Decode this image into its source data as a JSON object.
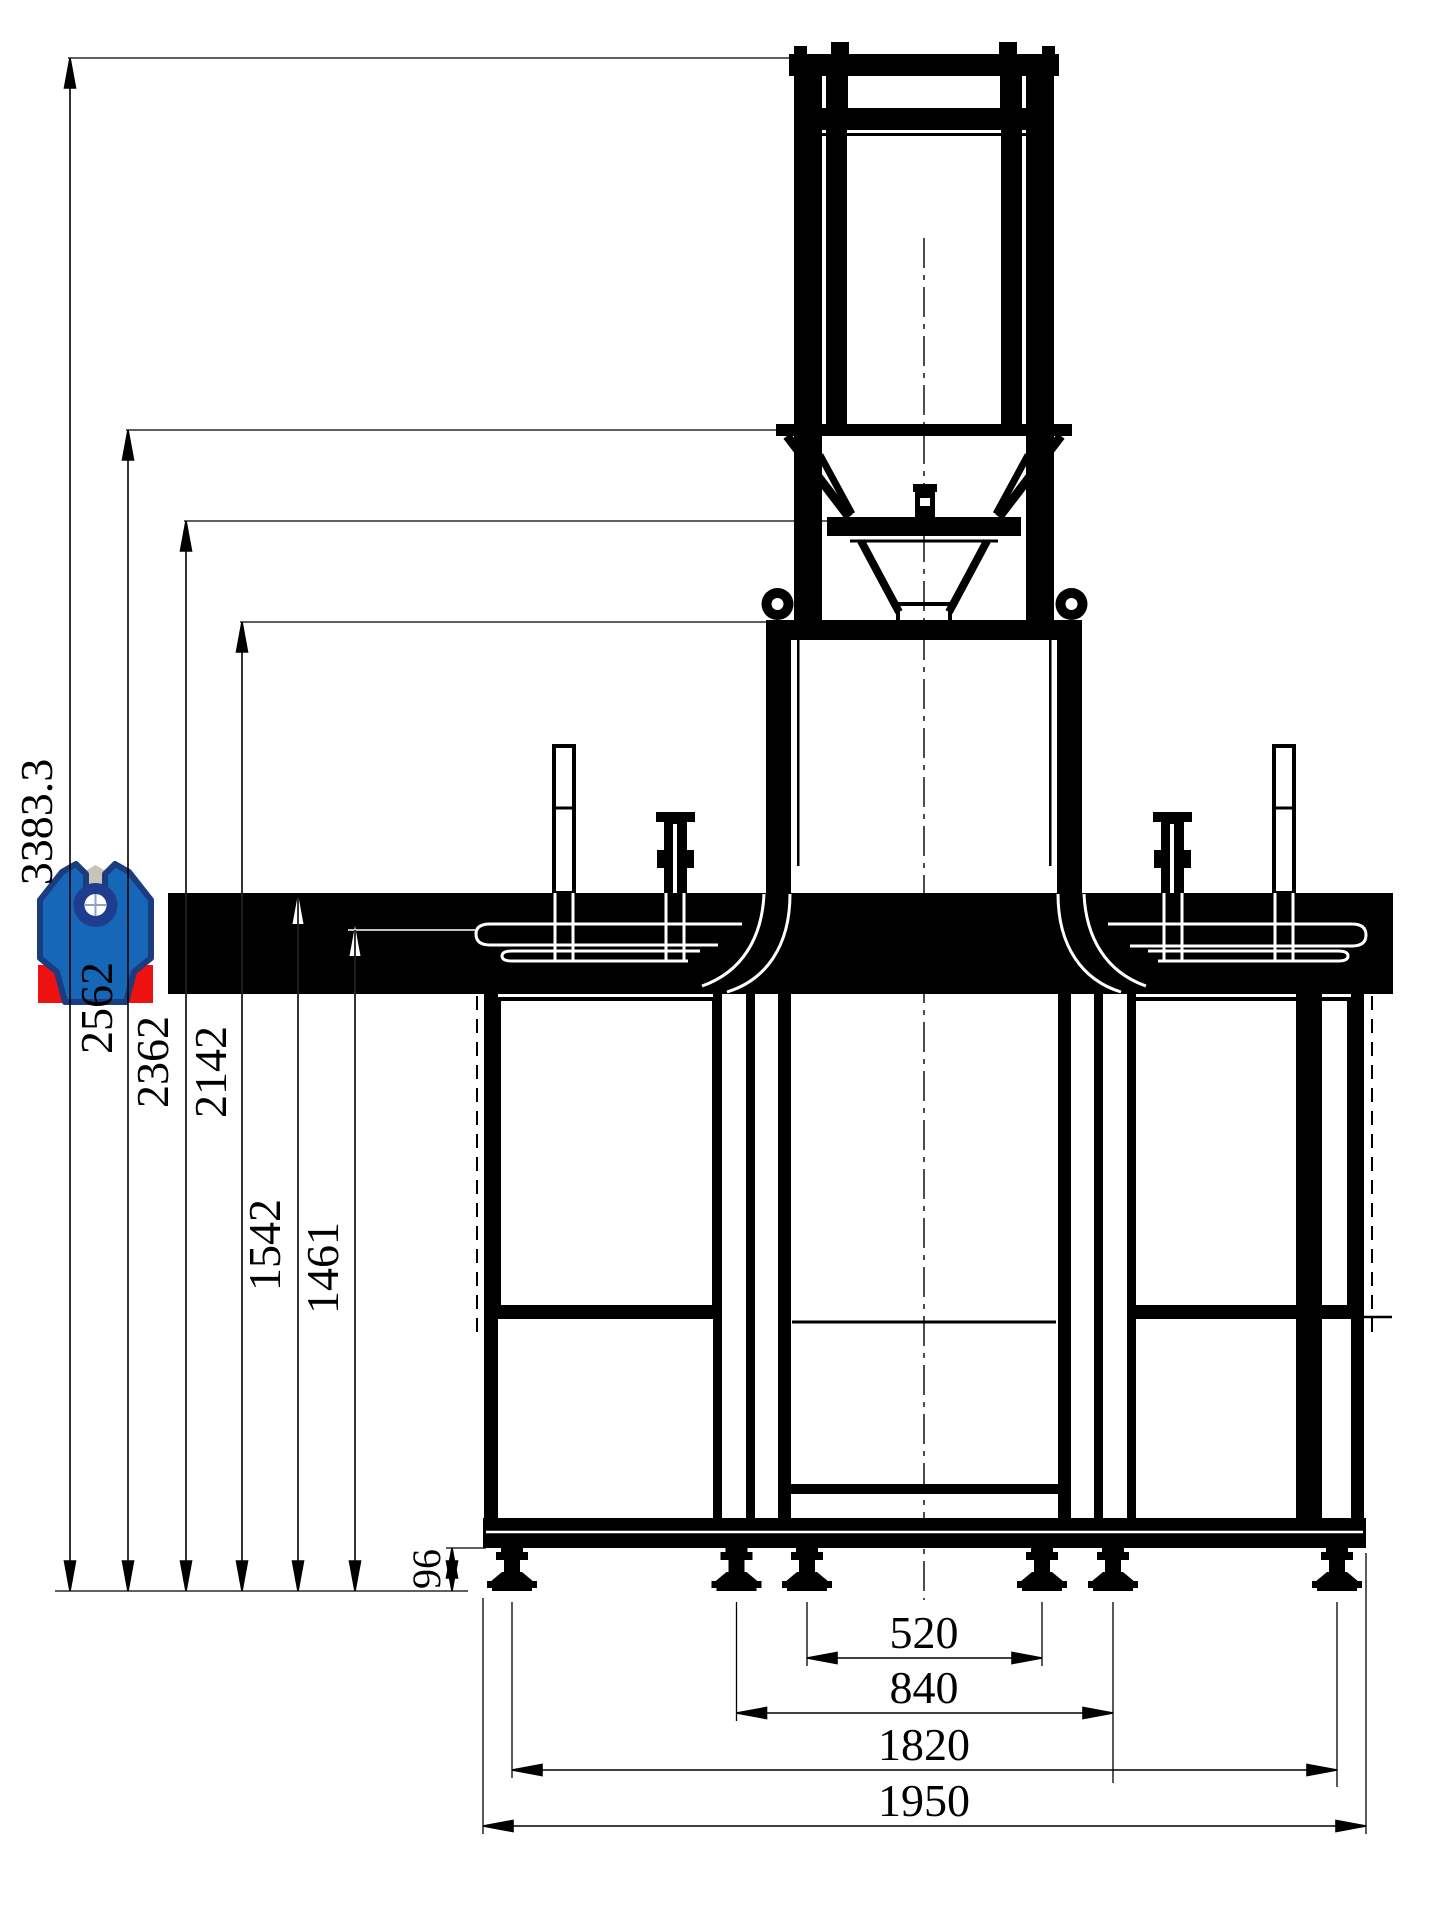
{
  "drawing": {
    "vertical_dimensions": {
      "total_height": "3383.3",
      "hopper_rim_height": "2562",
      "plate_height": "2362",
      "box_top_height": "2142",
      "table_height": "1542",
      "belt_height": "1461",
      "foot_clearance": "96"
    },
    "horizontal_dimensions": {
      "inner_feet_span": "520",
      "mid_feet_span": "840",
      "outer_feet_span": "1820",
      "frame_length": "1950"
    },
    "logo_colors": {
      "blue": "#1767b8",
      "navy": "#1b3c7e",
      "red": "#ee1111",
      "gray": "#c9c4ba",
      "ring": "#1e3d8f",
      "cross": "#93a3c4"
    }
  }
}
